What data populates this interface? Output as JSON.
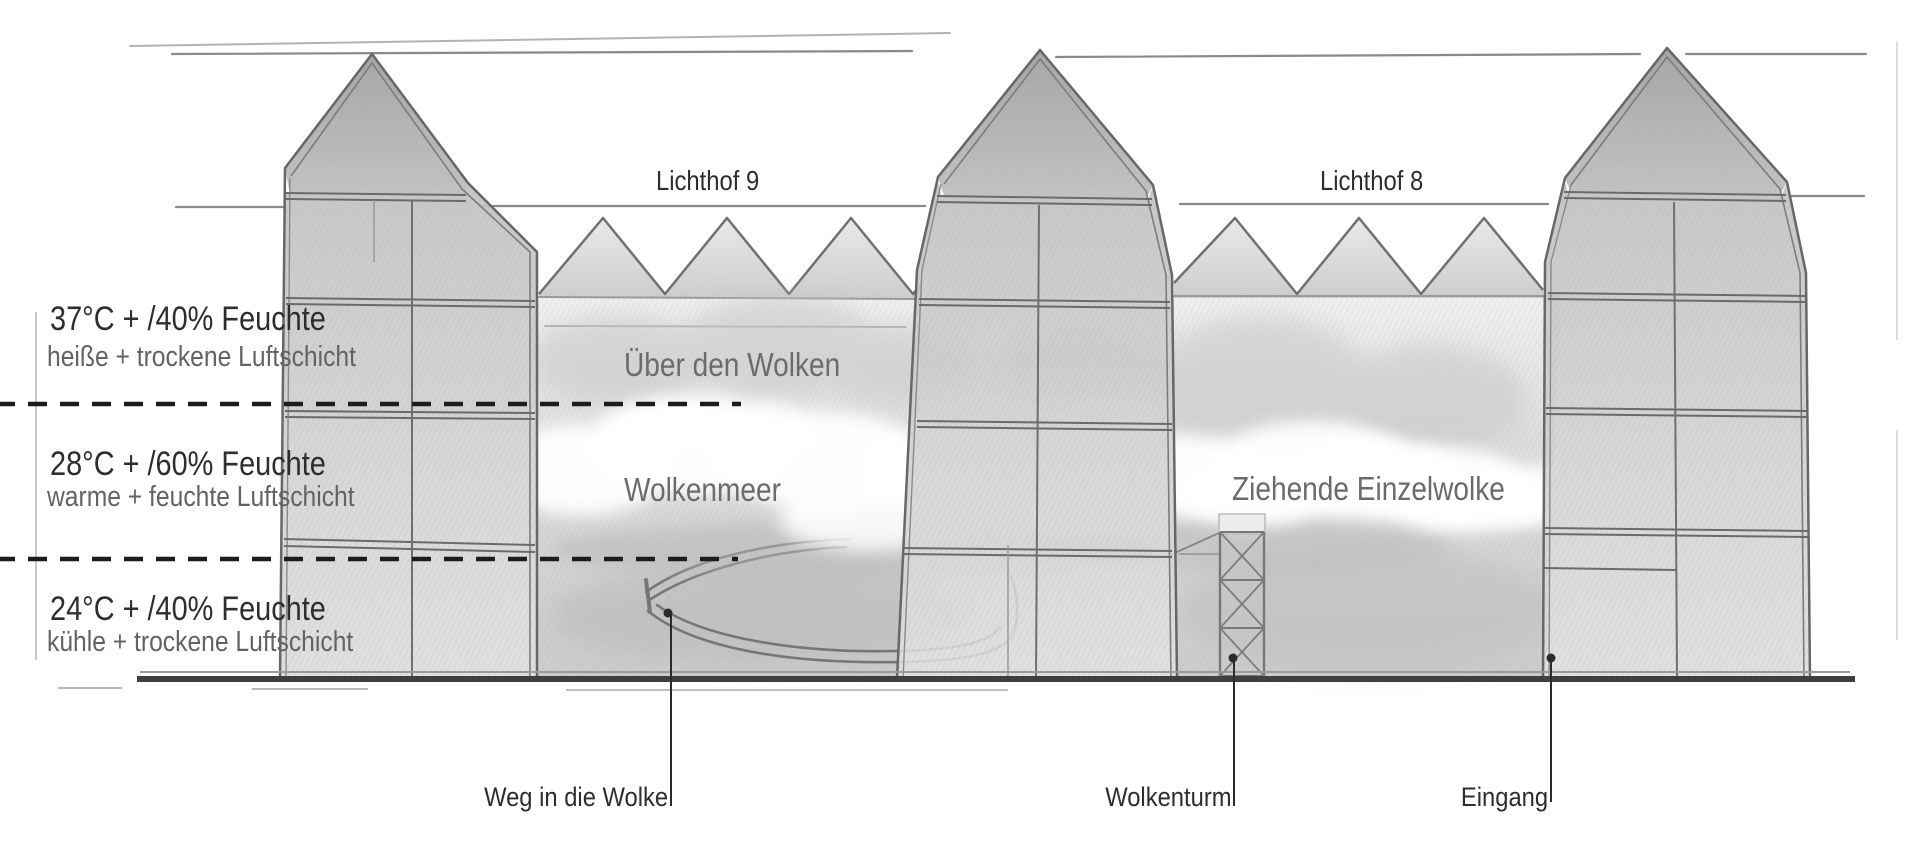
{
  "colors": {
    "ink": "#2e2e2e",
    "muted_label": "#6b6b6b",
    "pencil_line": "#777777",
    "ground": "#3f3f3f",
    "paper": "#ffffff"
  },
  "air_layers": [
    {
      "temp": "37°C + /40% Feuchte",
      "description": "heiße + trockene Luftschicht"
    },
    {
      "temp": "28°C + /60% Feuchte",
      "description": "warme + feuchte Luftschicht"
    },
    {
      "temp": "24°C + /40% Feuchte",
      "description": "kühle + trockene Luftschicht"
    }
  ],
  "atria": {
    "left": "Lichthof 9",
    "right": "Lichthof 8"
  },
  "cloud_zones": {
    "above_clouds": "Über den Wolken",
    "cloud_sea": "Wolkenmeer",
    "single_cloud": "Ziehende Einzelwolke"
  },
  "callouts": {
    "path_into_cloud": "Weg in die Wolke",
    "cloud_tower": "Wolkenturm",
    "entrance": "Eingang"
  }
}
